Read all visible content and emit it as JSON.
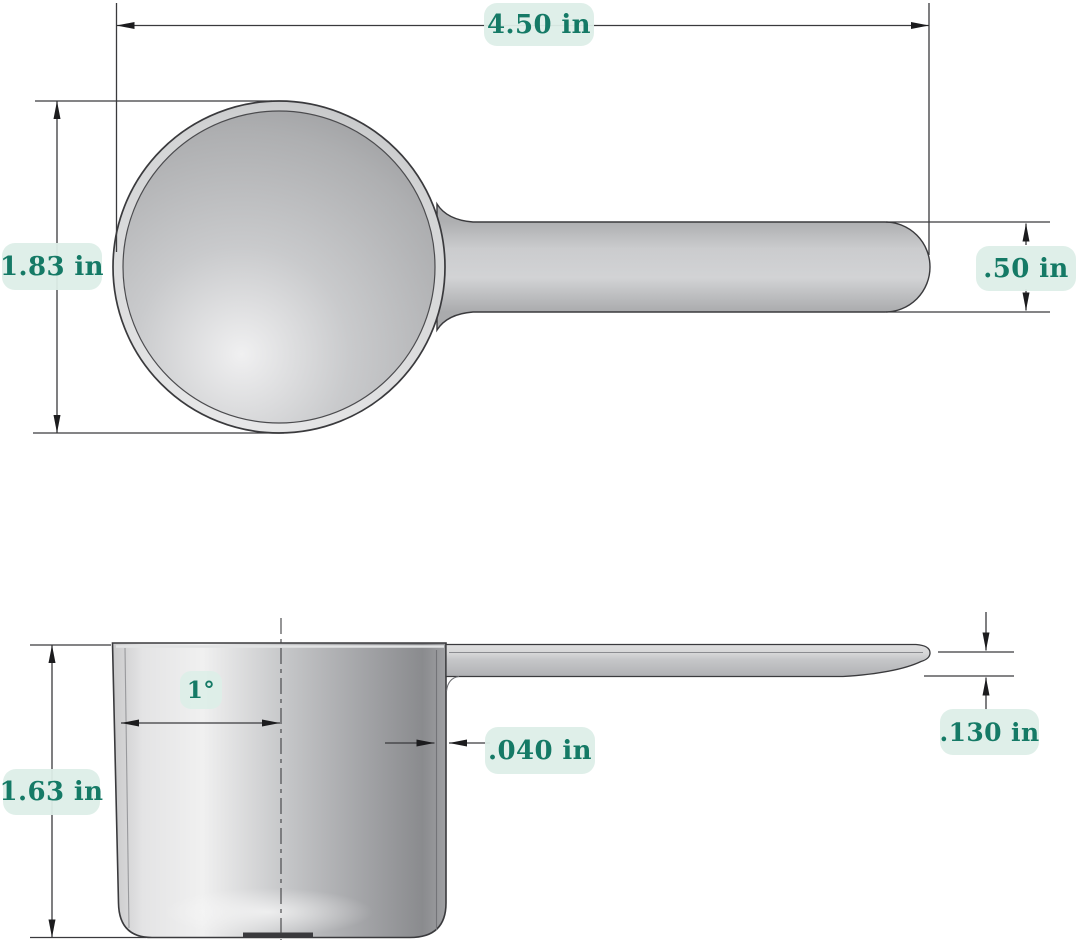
{
  "colors": {
    "background": "#ffffff",
    "label_background": "#ddeee8",
    "label_text": "#157a66",
    "line_color": "#3a3a3d",
    "scoop_gray": "#c4c5c7"
  },
  "dimensions": {
    "overall_length": "4.50 in",
    "bowl_diameter": "1.83 in",
    "handle_width": ".50 in",
    "cup_height": "1.63 in",
    "draft_angle": "1°",
    "wall_thickness": ".040 in",
    "handle_thickness": ".130 in"
  }
}
